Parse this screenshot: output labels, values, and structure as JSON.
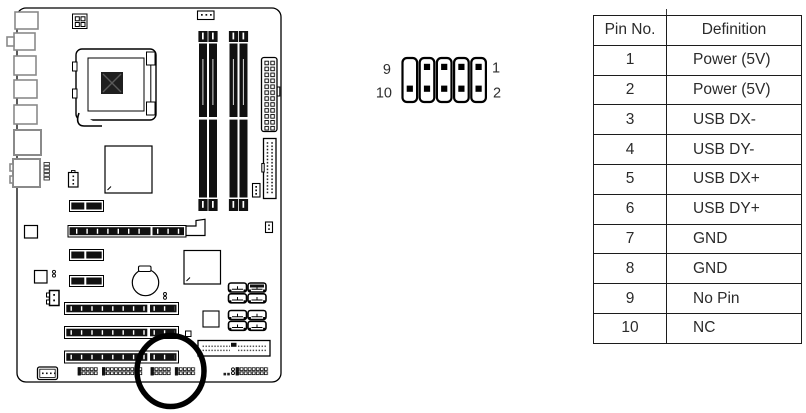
{
  "page": {
    "background": "#ffffff"
  },
  "pin_diagram": {
    "label_top_left": "9",
    "label_bottom_left": "10",
    "label_top_right": "1",
    "label_bottom_right": "2",
    "columns": 5,
    "rows": 2,
    "missing_pin": "9 (No Pin, top-left)"
  },
  "pin_table": {
    "headers": [
      "Pin No.",
      "Definition"
    ],
    "rows": [
      [
        "1",
        "Power (5V)"
      ],
      [
        "2",
        "Power (5V)"
      ],
      [
        "3",
        "USB DX-"
      ],
      [
        "4",
        "USB DY-"
      ],
      [
        "5",
        "USB DX+"
      ],
      [
        "6",
        "USB DY+"
      ],
      [
        "7",
        "GND"
      ],
      [
        "8",
        "GND"
      ],
      [
        "9",
        "No Pin"
      ],
      [
        "10",
        "NC"
      ]
    ]
  },
  "colors": {
    "line": "#000000",
    "slot_fill": "#111111",
    "port_outline": "#8a8a8a",
    "text": "#2b2b2b",
    "highlight": "#000000"
  }
}
